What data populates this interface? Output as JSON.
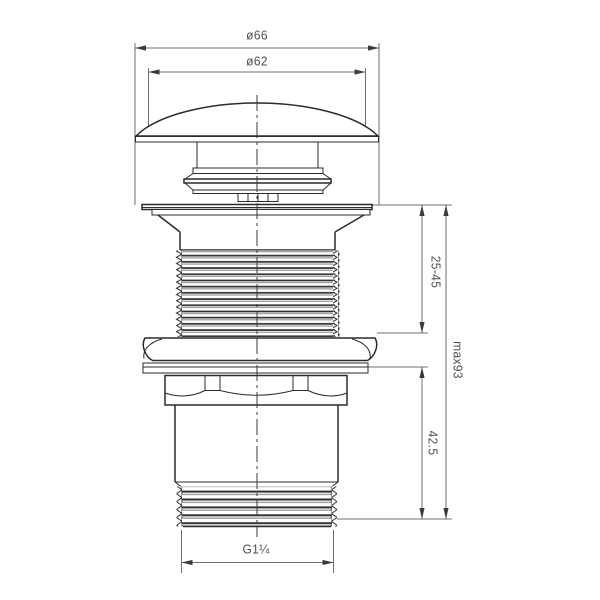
{
  "drawing": {
    "dimensions": {
      "cap_outer_diameter": "ø66",
      "cap_top_diameter": "ø62",
      "clamping_range": "25-45",
      "max_height": "max93",
      "lower_body_height": "42.5",
      "connection_thread": "G1¼"
    },
    "colors": {
      "outline": "#2b2b2b",
      "dimension_line": "#6f6f6f",
      "label_text": "#4f4f4f",
      "background": "#ffffff"
    }
  }
}
